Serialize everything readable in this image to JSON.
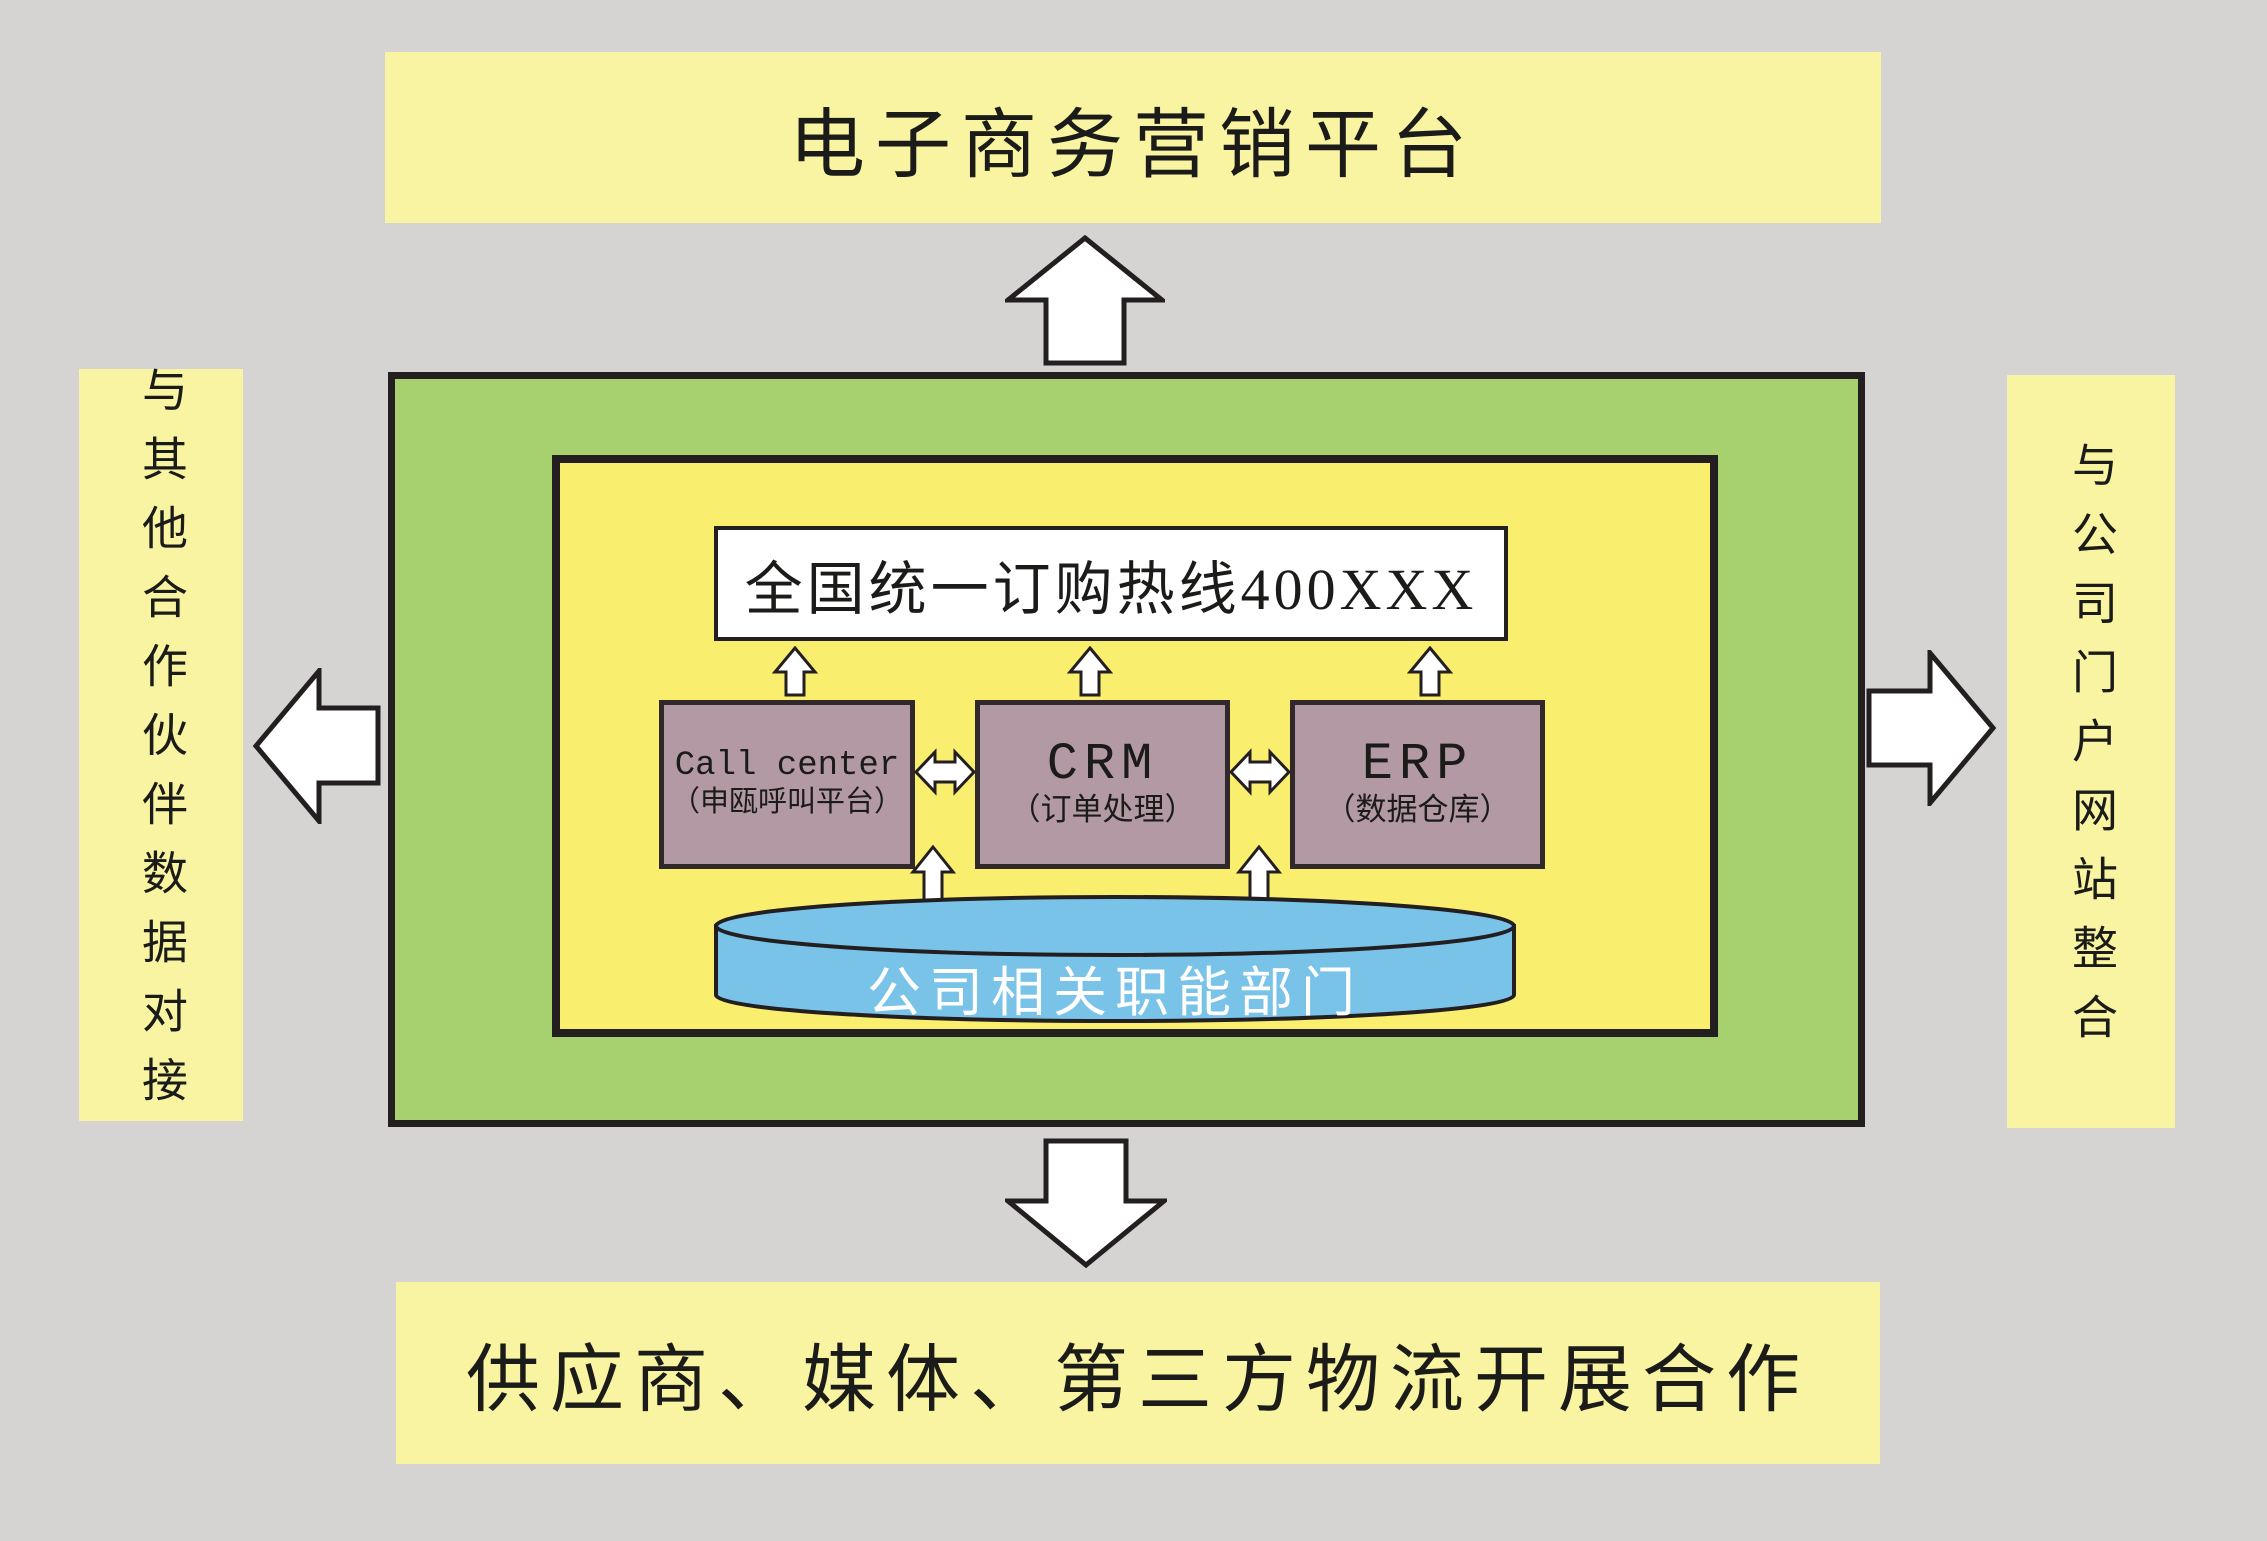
{
  "diagram": {
    "top_banner": "电子商务营销平台",
    "left_banner": "与其他合作伙伴数据对接",
    "right_banner": "与公司门户网站整合",
    "bottom_banner": "供应商、媒体、第三方物流开展合作",
    "hotline": "全国统一订购热线400XXX",
    "systems": [
      {
        "title": "Call center",
        "subtitle": "（申瓯呼叫平台）"
      },
      {
        "title": "CRM",
        "subtitle": "（订单处理）"
      },
      {
        "title": "ERP",
        "subtitle": "（数据仓库）"
      }
    ],
    "department_cylinder": "公司相关职能部门"
  },
  "colors": {
    "background_gray": "#d5d4d2",
    "banner_yellow": "#f8f4a1",
    "inner_yellow": "#f9ee6d",
    "green": "#a7d06f",
    "system_mauve": "#b399a3",
    "cylinder_blue": "#79c3e8",
    "outline_black": "#231f20",
    "arrow_white": "#ffffff"
  }
}
